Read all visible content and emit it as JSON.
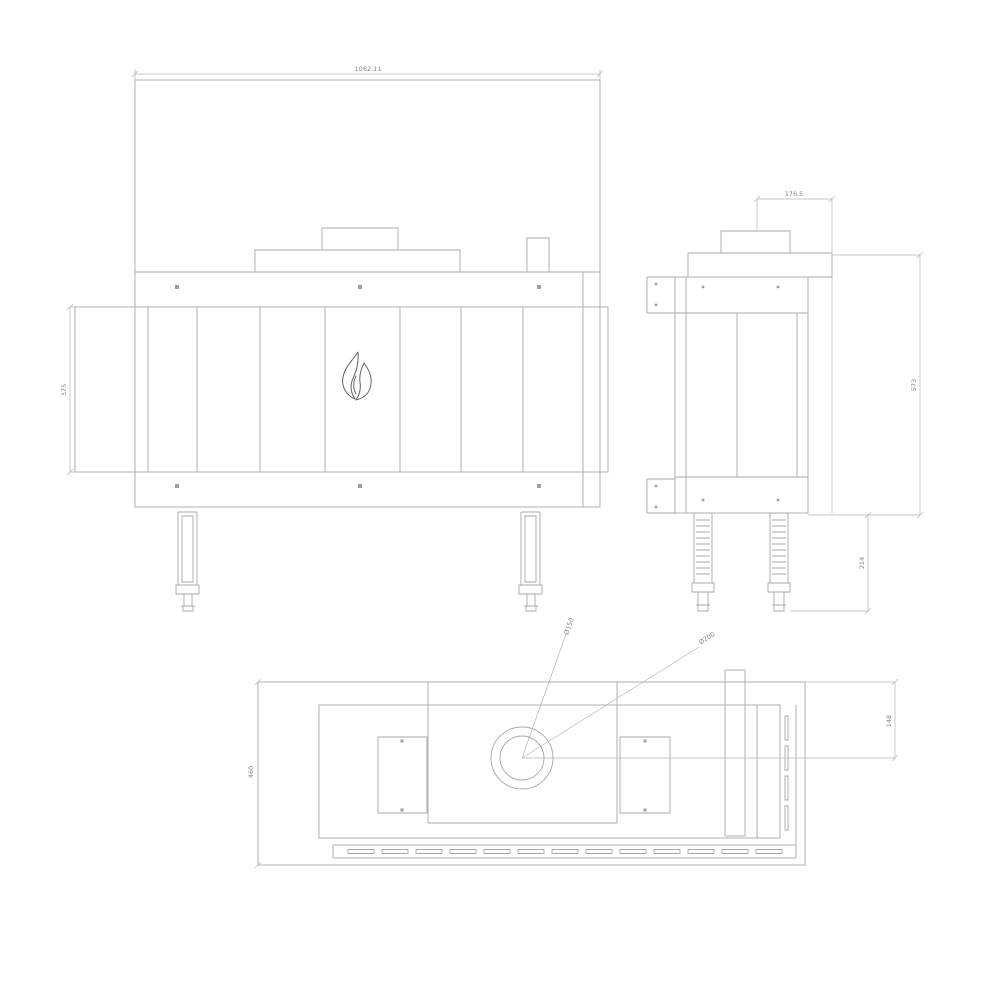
{
  "image": {
    "background_color": "#ffffff",
    "line_color": "#a6a9ab",
    "dim_text_color": "#85888a",
    "flame_color": "#5f6368"
  },
  "icons": {
    "flame_logo": "flame-icon"
  },
  "views": {
    "front_view": {
      "width_dim": "1062.11",
      "glass_height_dim": "375"
    },
    "side_view": {
      "flue_offset_dim": "176.5",
      "height_dim": "573",
      "leg_height_dim": "214"
    },
    "plan_view": {
      "depth_dim": "460",
      "flue_center_dim": "148",
      "flue_inner_diameter": "Ø150",
      "flue_outer_diameter": "Ø200"
    }
  }
}
